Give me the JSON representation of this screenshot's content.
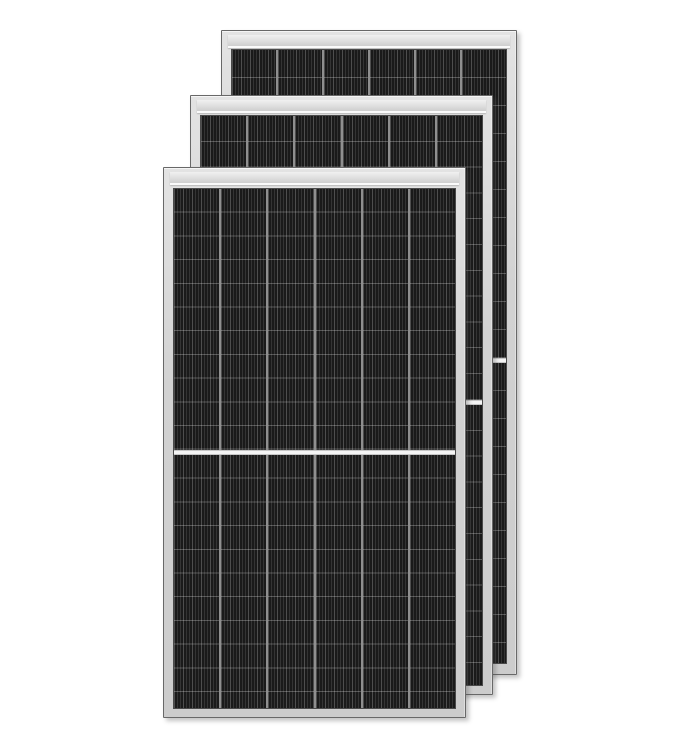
{
  "scene": {
    "description": "Product render of three framed monocrystalline half-cut solar panel modules, overlapped in a cascading stack on a plain white background. Each module has a light silver aluminium frame, a bright top frame rail, six columns of dark striped cells divided by thin light grid lines, and a white horizontal center divider splitting the cell area into two halves.",
    "object_count": 3
  },
  "colors": {
    "background": "#ffffff",
    "frame": "#d2d2d2",
    "frame_outline": "#686868",
    "top_rail": "#e0e0e0",
    "rail_highlight": "#fafafa",
    "cell_dark": "#1a1a1a",
    "cell_stripe": "#343434",
    "column_divider": "#8f8f8f",
    "row_line": "rgba(255,255,255,0.26)",
    "center_divider": "#f4f4f4",
    "drop_shadow": "rgba(70,70,70,0.32)"
  },
  "panels": [
    {
      "name": "solar-panel-back",
      "x": 221,
      "y": 30,
      "width": 296,
      "height": 645,
      "z": 1,
      "cells_top": 18,
      "cells_bottom": 10,
      "upper_half_height": 308,
      "divider_height": 5,
      "row_height": 28.0,
      "columns": 6,
      "rows_per_half": 11
    },
    {
      "name": "solar-panel-middle",
      "x": 190,
      "y": 95,
      "width": 303,
      "height": 600,
      "z": 2,
      "cells_top": 19,
      "cells_bottom": 8,
      "upper_half_height": 284,
      "divider_height": 5,
      "row_height": 25.8,
      "columns": 6,
      "rows_per_half": 11
    },
    {
      "name": "solar-panel-front",
      "x": 163,
      "y": 167,
      "width": 303,
      "height": 551,
      "z": 3,
      "cells_top": 20,
      "cells_bottom": 8,
      "upper_half_height": 261,
      "divider_height": 5,
      "row_height": 23.7,
      "columns": 6,
      "rows_per_half": 11
    }
  ]
}
